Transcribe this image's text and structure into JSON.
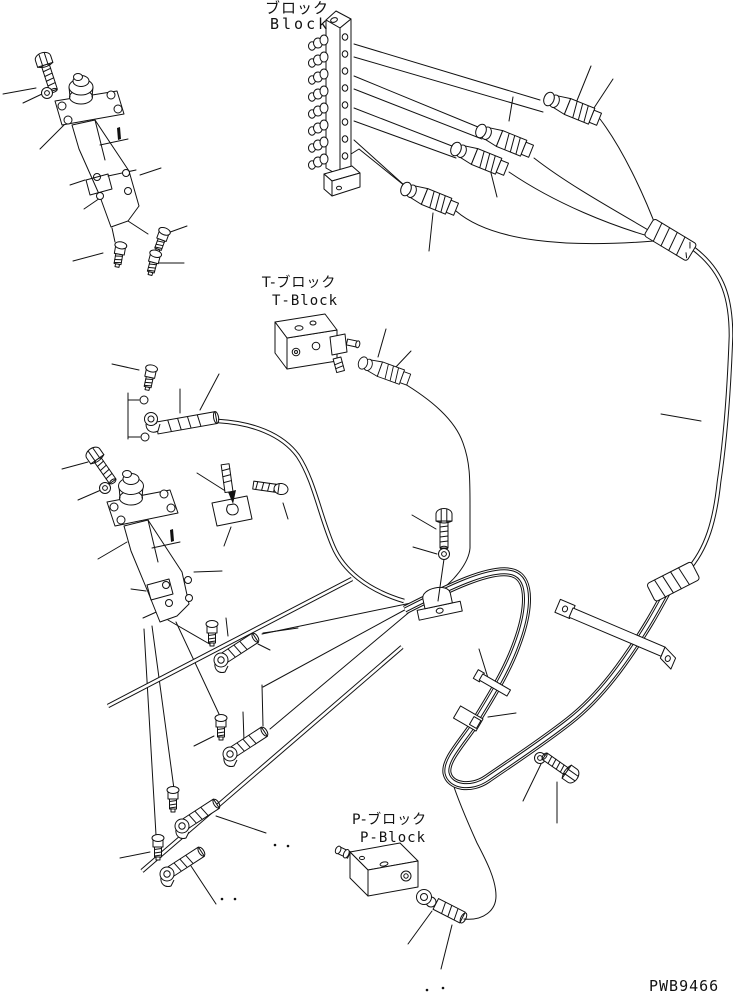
{
  "page": {
    "background": "#ffffff",
    "line_color": "#111111"
  },
  "diagram": {
    "labels": {
      "block_jp": "ブロック",
      "block_en": "Block",
      "t_block_jp": "T-ブロック",
      "t_block_en": "T-Block",
      "p_block_jp": "P-ブロック",
      "p_block_en": "P-Block"
    },
    "drawing_number": "PWB9466"
  }
}
